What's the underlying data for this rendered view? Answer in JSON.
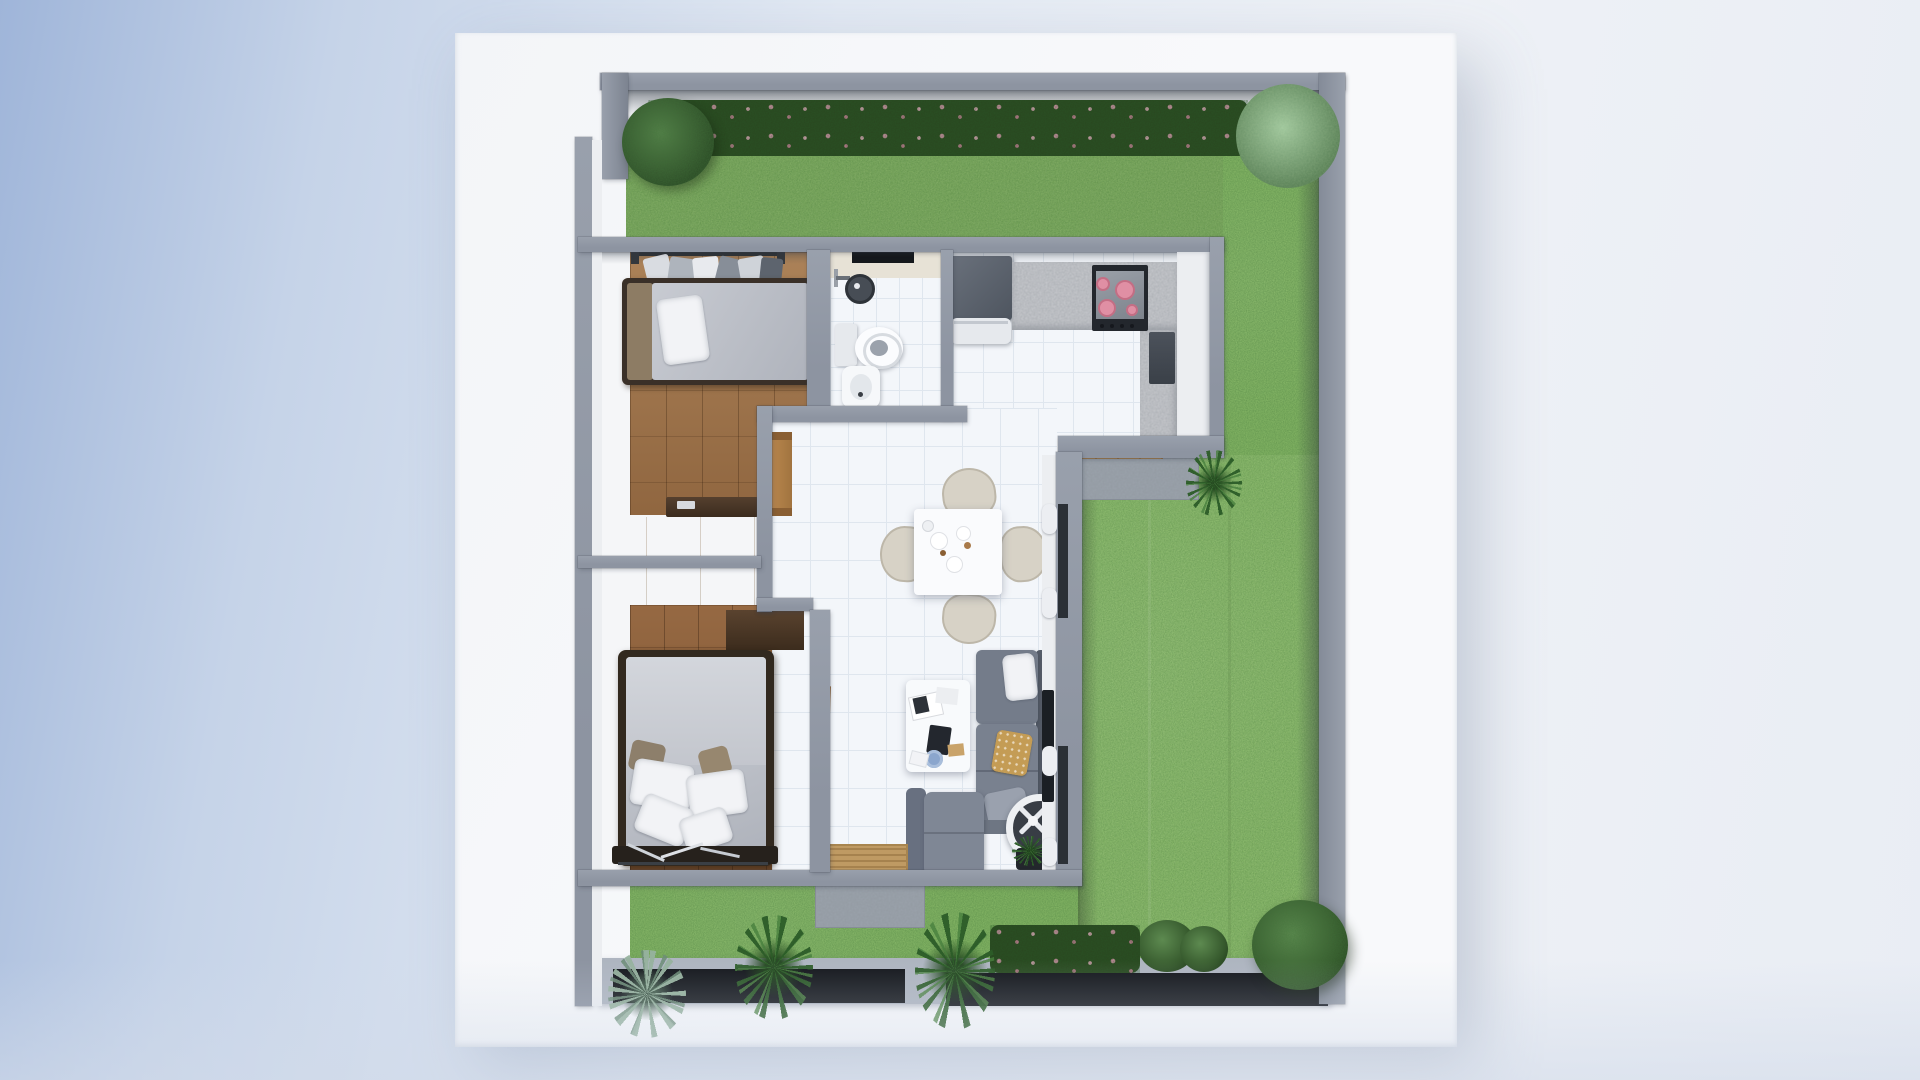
{
  "scene": {
    "title": "Top-down 3D floor plan render of a small house with wrap-around garden",
    "view": "top-down axonometric 3D render, no visible text",
    "background": "pale blue-to-white gradient studio backdrop",
    "site": {
      "base": "white rectangular plot platform",
      "boundary": [
        "gray perimeter wall top",
        "gray perimeter wall right",
        "gray perimeter wall left with offset corner gap",
        "front fence with dark infill panels and light curb"
      ],
      "hardscape": [
        "entry concrete pad",
        "kitchen patio slab",
        "wooden deck step",
        "tan doormat inside entry"
      ]
    },
    "garden": {
      "lawns": [
        "top lawn strip",
        "large right lawn",
        "front lawn strip"
      ],
      "plants": [
        "round tree top-left",
        "flowering hedge along top wall",
        "feathery tree top-right",
        "palm beside kitchen patio",
        "front palm left",
        "front palm right",
        "agave bottom-left",
        "flowering hedge front-right",
        "bush cluster bottom-right",
        "large round bush bottom-right corner"
      ]
    },
    "house": {
      "rooms": [
        {
          "name": "bedroom 1",
          "floor": "mid-tone wood planks",
          "furniture": [
            "open wardrobe rail with hanging clothes",
            "single bed, gray mattress, white pillow, tan blanket",
            "dark low dresser"
          ]
        },
        {
          "name": "wardrobe hall",
          "floor": "light wood",
          "furniture": [
            "sliding-door closet bedroom 1",
            "sliding-door closet bedroom 2",
            "wooden console",
            "wooden door leaf"
          ]
        },
        {
          "name": "bedroom 2",
          "floor": "dark wood planks",
          "furniture": [
            "double bed with four white pillows and tan cushions",
            "clothes bench at foot of bed",
            "dark corner shelf"
          ]
        },
        {
          "name": "bathroom",
          "floor": "white tile",
          "fixtures": [
            "ceiling vent",
            "shower head",
            "toilet",
            "bidet"
          ]
        },
        {
          "name": "kitchen",
          "floor": "white tile",
          "fixtures": [
            "dark refrigerator",
            "white dishwasher",
            "granite counter",
            "cooktop with four pink burners",
            "dark base cabinet"
          ]
        },
        {
          "name": "living dining room",
          "floor": "white tile",
          "furniture": [
            "square dining table with plates and pastries",
            "four beige chairs",
            "white coffee table with magazines, tablet and blue dish",
            "L-shaped gray sofa with white, mustard and gray cushions",
            "gray armchair",
            "white pedestal fan",
            "potted plant",
            "wall TV",
            "two curtained windows on right wall"
          ]
        }
      ]
    },
    "palette": {
      "bgA": "#9fb5d9",
      "bgB": "#eef1f6",
      "plot": "#f8f9fb",
      "wall": "#8d94a1",
      "wallDark": "#59606c",
      "wallFace": "#eceef1",
      "grass": "#8abb68",
      "grassDeep": "#7aa85a",
      "hedge": "#2a451f",
      "treeDark": "#3a5c33",
      "treeLight": "#7fa87d",
      "wood1": "#a0744a",
      "wood2": "#8a5c36",
      "woodLight": "#cbb089",
      "furnWood": "#46332a",
      "tile": "#f3f6fa",
      "tileLine": "#dfe6ee",
      "counter": "#c6c8cc",
      "appliance": "#575e68",
      "cooktop": "#23272d",
      "burner": "#e08fa4",
      "sofa": "#79818f",
      "sofaDark": "#565d69",
      "chair": "#d7d2c6",
      "mattress": "#c0c3ca",
      "concrete": "#9aa2ab",
      "fence": "#14171c",
      "curb": "#aeb5c0",
      "mat": "#bf9a63"
    }
  }
}
